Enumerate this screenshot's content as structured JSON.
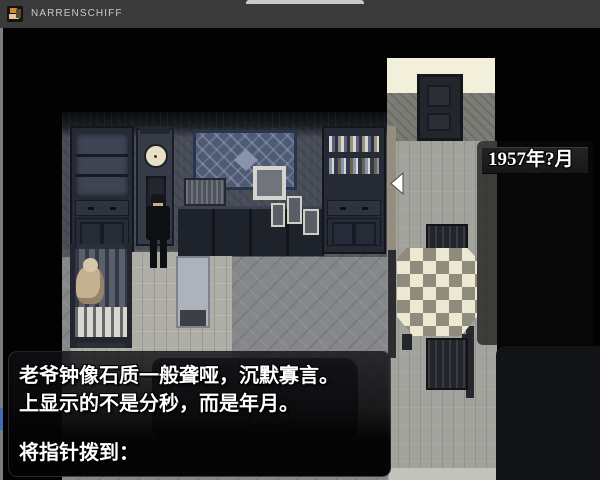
{
  "window": {
    "title": "NARRENSCHIFF",
    "controls": {
      "minimize": "—",
      "maximize": "□",
      "close": "✕"
    }
  },
  "choice_menu": {
    "items": [
      {
        "label": "1952年5月",
        "selected": true
      },
      {
        "label": "1953年12月",
        "selected": false
      },
      {
        "label": "1954年3月",
        "selected": false
      },
      {
        "label": "1955年10月",
        "selected": false
      },
      {
        "label": "1956年1月",
        "selected": false
      },
      {
        "label": "1957年?月",
        "selected": false
      }
    ],
    "selected_index": 0
  },
  "dialogue": {
    "line1": "老爷钟像石质一般聋哑，沉默寡言。",
    "line2": "上显示的不是分秒，而是年月。",
    "prompt": "将指针拨到："
  },
  "colors": {
    "titlebar": "#3a3a3a",
    "selected_highlight": "#2e382f",
    "menu_item_bg": "#1d1d1d",
    "corridor_ceiling": "#f2f0da",
    "message_window_tint": "rgba(10,10,12,0.88)",
    "text": "#ffffff"
  }
}
